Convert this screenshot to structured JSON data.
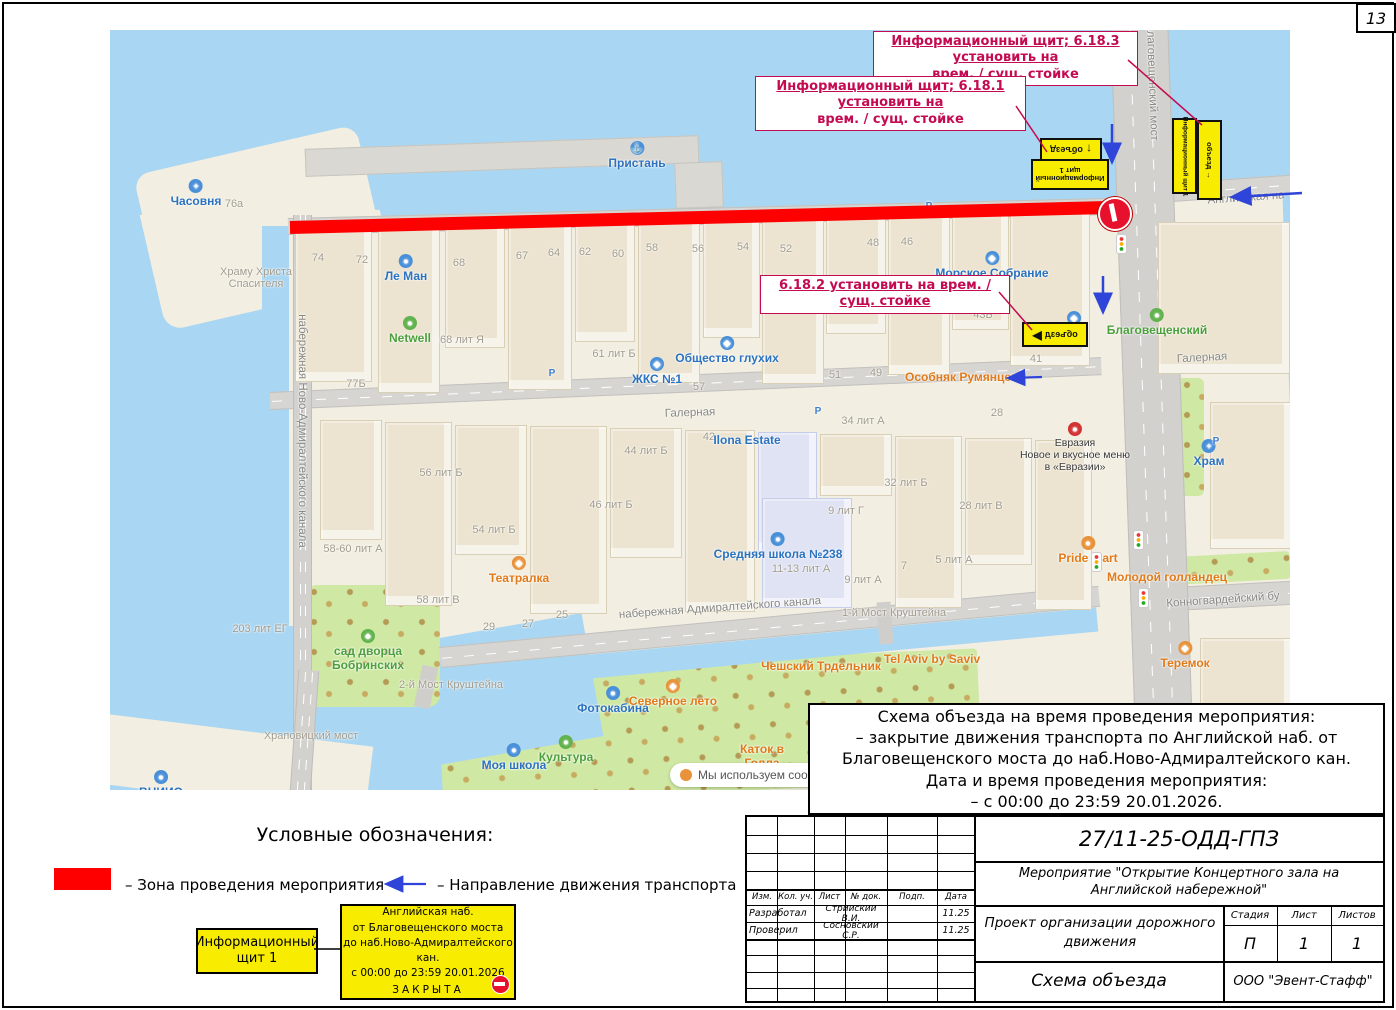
{
  "page": {
    "number": "13"
  },
  "annotations": {
    "a1_line1": "Информационный щит; 6.18.3 установить на",
    "a1_line2": "врем. / сущ. стойке",
    "a2_line1": "Информационный щит; 6.18.1 установить на",
    "a2_line2": "врем. / сущ. стойке",
    "a3_text": "6.18.2 установить на врем. / сущ. стойке"
  },
  "signs": {
    "detour": "объезд",
    "info_board_line1": "Информационный",
    "info_board_line2": "щит 1",
    "info_board_full": "Информационный щит 1"
  },
  "legend": {
    "title": "Условные обозначения:",
    "zone": "– Зона проведения мероприятия",
    "direction": "– Направление движения транспорта"
  },
  "info_board": {
    "content": [
      "Английская наб.",
      "от Благовещенского моста",
      "до наб.Ново-Адмиралтейского кан.",
      "с 00:00 до 23:59 20.01.2026"
    ],
    "closed": "ЗАКРЫТА"
  },
  "description": [
    "Схема объезда на время проведения мероприятия:",
    "– закрытие движения транспорта по Английской наб. от",
    "Благовещенского моста до наб.Ново-Адмиралтейского кан.",
    "Дата и время проведения мероприятия:",
    "– с 00:00 до 23:59 20.01.2026."
  ],
  "title_block": {
    "doc_number": "27/11-25-ОДД-ГПЗ",
    "project": "Мероприятие \"Открытие Концертного зала на Английской набережной\"",
    "header_cols": [
      "Изм.",
      "Кол. уч.",
      "Лист",
      "№ док.",
      "Подп.",
      "Дата"
    ],
    "rows": [
      {
        "role": "Разработал",
        "name": "Стрийский В.И.",
        "date": "11.25"
      },
      {
        "role": "Проверил",
        "name": "Сосновский С.Р.",
        "date": "11.25"
      }
    ],
    "org_block": "Проект организации дорожного движения",
    "stage_label": "Стадия",
    "sheet_label": "Лист",
    "sheets_label": "Листов",
    "stage": "П",
    "sheet": "1",
    "sheets": "1",
    "scheme_title": "Схема объезда",
    "company": "ООО \"Эвент-Стафф\""
  },
  "map": {
    "cookie": "Мы используем cookies",
    "labels": [
      {
        "t": "poi",
        "x": 86,
        "y": 148,
        "text": "Часовня",
        "icon": "chapel-icon",
        "g": "+"
      },
      {
        "t": "num",
        "x": 124,
        "y": 168,
        "text": "76а"
      },
      {
        "t": "num",
        "x": 146,
        "y": 236,
        "text": "Храму Христа\nСпасителя"
      },
      {
        "t": "poi",
        "x": 527,
        "y": 110,
        "text": "Пристань",
        "icon": "pier-icon",
        "g": "⚓"
      },
      {
        "t": "num",
        "x": 208,
        "y": 222,
        "text": "74"
      },
      {
        "t": "num",
        "x": 252,
        "y": 224,
        "text": "72"
      },
      {
        "t": "poi",
        "x": 296,
        "y": 223,
        "text": "Ле Ман",
        "icon": "printer-icon",
        "g": "●"
      },
      {
        "t": "num",
        "x": 349,
        "y": 227,
        "text": "68"
      },
      {
        "t": "num",
        "x": 412,
        "y": 220,
        "text": "67"
      },
      {
        "t": "num",
        "x": 444,
        "y": 217,
        "text": "64"
      },
      {
        "t": "num",
        "x": 475,
        "y": 216,
        "text": "62"
      },
      {
        "t": "num",
        "x": 508,
        "y": 218,
        "text": "60"
      },
      {
        "t": "num",
        "x": 542,
        "y": 212,
        "text": "58"
      },
      {
        "t": "num",
        "x": 588,
        "y": 213,
        "text": "56"
      },
      {
        "t": "num",
        "x": 633,
        "y": 211,
        "text": "54"
      },
      {
        "t": "num",
        "x": 676,
        "y": 213,
        "text": "52"
      },
      {
        "t": "num",
        "x": 763,
        "y": 207,
        "text": "48"
      },
      {
        "t": "num",
        "x": 797,
        "y": 206,
        "text": "46"
      },
      {
        "t": "poi",
        "x": 882,
        "y": 220,
        "text": "Морское Собрание",
        "icon": "poi-icon",
        "g": "◆"
      },
      {
        "t": "green",
        "x": 300,
        "y": 285,
        "text": "Netwell",
        "icon": "office-icon",
        "g": "●"
      },
      {
        "t": "num",
        "x": 352,
        "y": 304,
        "text": "68 лит Я"
      },
      {
        "t": "num",
        "x": 504,
        "y": 318,
        "text": "61 лит Б"
      },
      {
        "t": "poi",
        "x": 547,
        "y": 326,
        "text": "ЖКС №1",
        "icon": "poi-icon",
        "g": "◆"
      },
      {
        "t": "poi",
        "x": 617,
        "y": 305,
        "text": "Общество глухих",
        "icon": "poi-icon",
        "g": "◆"
      },
      {
        "t": "num",
        "x": 589,
        "y": 351,
        "text": "57"
      },
      {
        "t": "num",
        "x": 725,
        "y": 339,
        "text": "51"
      },
      {
        "t": "num",
        "x": 766,
        "y": 337,
        "text": "49"
      },
      {
        "t": "food",
        "x": 855,
        "y": 340,
        "text": "Особняк Румянцева"
      },
      {
        "t": "num",
        "x": 873,
        "y": 279,
        "text": "43Б"
      },
      {
        "t": "num",
        "x": 926,
        "y": 323,
        "text": "41"
      },
      {
        "t": "poi",
        "x": 964,
        "y": 280,
        "text": "СУД",
        "icon": "poi-icon",
        "g": "◆"
      },
      {
        "t": "green",
        "x": 1047,
        "y": 277,
        "text": "Благовещенский",
        "icon": "landmark-icon",
        "g": "●"
      },
      {
        "t": "street",
        "x": 1092,
        "y": 322,
        "r": -3,
        "text": "Галерная"
      },
      {
        "t": "poi",
        "x": 1099,
        "y": 408,
        "text": "Храм",
        "icon": "church-icon",
        "g": "+"
      },
      {
        "t": "ad",
        "x": 965,
        "y": 392,
        "text": "Евразия\nНовое и вкусное меню\nв «Евразии»",
        "icon": "ad-icon",
        "g": "●"
      },
      {
        "t": "num",
        "x": 887,
        "y": 377,
        "text": "28"
      },
      {
        "t": "num",
        "x": 753,
        "y": 385,
        "text": "34 лит А"
      },
      {
        "t": "street",
        "x": 580,
        "y": 377,
        "r": -2,
        "text": "Галерная"
      },
      {
        "t": "num",
        "x": 599,
        "y": 401,
        "text": "42"
      },
      {
        "t": "poi",
        "x": 637,
        "y": 403,
        "text": "Ilona Estate"
      },
      {
        "t": "num",
        "x": 536,
        "y": 415,
        "text": "44 лит Б"
      },
      {
        "t": "num",
        "x": 331,
        "y": 437,
        "text": "56 лит Б"
      },
      {
        "t": "num",
        "x": 796,
        "y": 447,
        "text": "32 лит Б"
      },
      {
        "t": "num",
        "x": 736,
        "y": 475,
        "text": "9 лит Г"
      },
      {
        "t": "num",
        "x": 501,
        "y": 469,
        "text": "46 лит Б"
      },
      {
        "t": "num",
        "x": 871,
        "y": 470,
        "text": "28 лит В"
      },
      {
        "t": "num",
        "x": 384,
        "y": 494,
        "text": "54 лит Б"
      },
      {
        "t": "food",
        "x": 409,
        "y": 525,
        "text": "Театралка",
        "icon": "poi-icon",
        "g": "◆"
      },
      {
        "t": "poi",
        "x": 668,
        "y": 501,
        "text": "Средняя школа №238",
        "icon": "school-icon",
        "g": "●"
      },
      {
        "t": "num",
        "x": 691,
        "y": 533,
        "text": "11-13 лит А"
      },
      {
        "t": "num",
        "x": 753,
        "y": 544,
        "text": "9 лит А"
      },
      {
        "t": "num",
        "x": 794,
        "y": 530,
        "text": "7"
      },
      {
        "t": "num",
        "x": 844,
        "y": 524,
        "text": "5 лит А"
      },
      {
        "t": "food",
        "x": 978,
        "y": 505,
        "text": "Pride mart",
        "icon": "shop-icon",
        "g": "●"
      },
      {
        "t": "food",
        "x": 1057,
        "y": 540,
        "text": "Молодой голландец"
      },
      {
        "t": "street",
        "x": 1113,
        "y": 564,
        "r": -4,
        "text": "Конногвардейский бу"
      },
      {
        "t": "food",
        "x": 1075,
        "y": 610,
        "text": "Теремок",
        "icon": "food-icon",
        "g": "◆"
      },
      {
        "t": "num",
        "x": 243,
        "y": 513,
        "text": "58-60 лит А"
      },
      {
        "t": "num",
        "x": 328,
        "y": 564,
        "text": "58 лит В"
      },
      {
        "t": "green",
        "x": 258,
        "y": 598,
        "text": "сад дворца\nБобринских",
        "icon": "tree-icon",
        "g": "♣"
      },
      {
        "t": "num",
        "x": 150,
        "y": 593,
        "text": "203 лит ЕГ"
      },
      {
        "t": "num",
        "x": 379,
        "y": 591,
        "text": "29"
      },
      {
        "t": "num",
        "x": 418,
        "y": 588,
        "text": "27"
      },
      {
        "t": "num",
        "x": 452,
        "y": 579,
        "text": "25"
      },
      {
        "t": "street",
        "x": 610,
        "y": 572,
        "r": -4,
        "text": "набережная Адмиралтейского канала"
      },
      {
        "t": "num",
        "x": 784,
        "y": 577,
        "text": "1-й Мост Круштейна"
      },
      {
        "t": "num",
        "x": 341,
        "y": 649,
        "text": "2-й Мост Круштейна"
      },
      {
        "t": "poi",
        "x": 503,
        "y": 655,
        "text": "Фотокабина",
        "icon": "camera-icon",
        "g": "●"
      },
      {
        "t": "food",
        "x": 563,
        "y": 648,
        "text": "Северное лето",
        "icon": "poi-icon",
        "g": "◆"
      },
      {
        "t": "food",
        "x": 711,
        "y": 629,
        "text": "Чешский Трдельник"
      },
      {
        "t": "food",
        "x": 822,
        "y": 622,
        "text": "Tel Aviv by Saviv"
      },
      {
        "t": "food",
        "x": 652,
        "y": 712,
        "text": "Каток в\nГолла"
      },
      {
        "t": "poi",
        "x": 404,
        "y": 712,
        "text": "Моя школа",
        "icon": "school-icon",
        "g": "●"
      },
      {
        "t": "green",
        "x": 456,
        "y": 704,
        "text": "Культура",
        "icon": "shop-icon",
        "g": "●"
      },
      {
        "t": "num",
        "x": 201,
        "y": 700,
        "text": "Храповицкий мост"
      },
      {
        "t": "poi",
        "x": 51,
        "y": 739,
        "text": "ВНИИО",
        "icon": "institute-icon",
        "g": "●"
      },
      {
        "t": "street",
        "x": 1136,
        "y": 162,
        "r": -4,
        "text": "Английская на"
      },
      {
        "t": "street",
        "x": 192,
        "y": 395,
        "r": 90,
        "text": "набережная Ново-Адмиралтейского канала"
      },
      {
        "t": "num",
        "x": 246,
        "y": 348,
        "text": "77Б"
      },
      {
        "t": "street",
        "x": 1042,
        "y": 46,
        "r": 88,
        "text": "Благовещенский мост"
      },
      {
        "t": "pk",
        "x": 442,
        "y": 338,
        "text": "P"
      },
      {
        "t": "pk",
        "x": 708,
        "y": 376,
        "text": "P"
      },
      {
        "t": "pk",
        "x": 819,
        "y": 171,
        "text": "P"
      },
      {
        "t": "pk",
        "x": 1106,
        "y": 406,
        "text": "P"
      }
    ]
  }
}
